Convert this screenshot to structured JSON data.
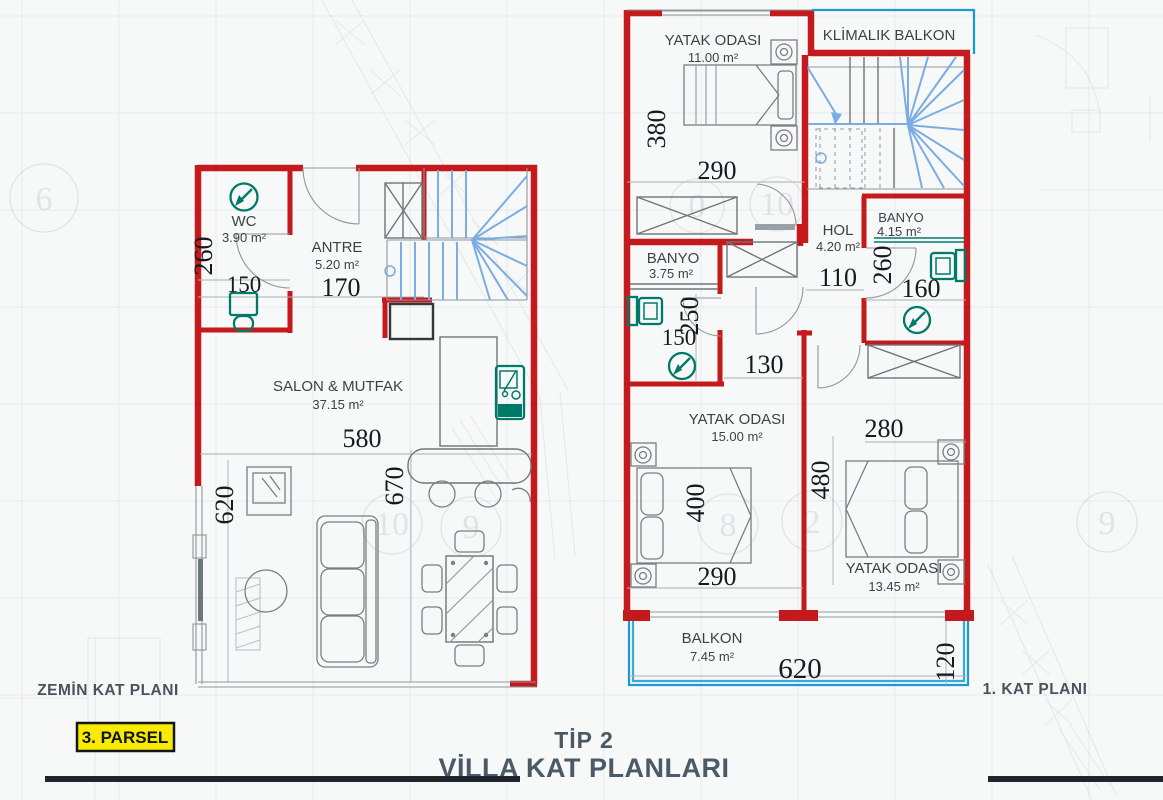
{
  "ground_floor": {
    "plan_label": "ZEMİN KAT PLANI",
    "rooms": {
      "wc": {
        "name": "WC",
        "area": "3.90 m²"
      },
      "antre": {
        "name": "ANTRE",
        "area": "5.20 m²"
      },
      "salon": {
        "name": "SALON & MUTFAK",
        "area": "37.15 m²"
      }
    },
    "dims": {
      "left_height": "260",
      "wc_width": "150",
      "antre_width": "170",
      "salon_width": "580",
      "salon_height_right": "670",
      "salon_height_left": "620"
    }
  },
  "first_floor": {
    "plan_label": "1. KAT PLANI",
    "rooms": {
      "bedroom1": {
        "name": "YATAK ODASI",
        "area": "11.00 m²"
      },
      "klimalik_balkon": {
        "name": "KLİMALIK BALKON"
      },
      "hol": {
        "name": "HOL",
        "area": "4.20 m²"
      },
      "banyo_right": {
        "name": "BANYO",
        "area": "4.15 m²"
      },
      "banyo_left": {
        "name": "BANYO",
        "area": "3.75 m²"
      },
      "bedroom2": {
        "name": "YATAK ODASI",
        "area": "15.00 m²"
      },
      "bedroom3": {
        "name": "YATAK ODASI",
        "area": "13.45 m²"
      },
      "balkon": {
        "name": "BALKON",
        "area": "7.45 m²"
      }
    },
    "dims": {
      "bedroom1_height": "380",
      "bedroom1_width": "290",
      "hol_width": "110",
      "banyo_right_height": "260",
      "banyo_right_width": "160",
      "banyo_left_height": "250",
      "banyo_left_width": "150",
      "corridor_width": "130",
      "bedroom3_width": "280",
      "bedroom2_height": "400",
      "bedroom2_width": "290",
      "bedroom3_height": "480",
      "balkon_width": "620",
      "balkon_height": "120"
    }
  },
  "footer": {
    "type_label": "TİP 2",
    "title": "VİLLA KAT PLANLARI",
    "parsel_label": "3. PARSEL"
  },
  "ghosts": {
    "n6": "6",
    "n10_left": "10",
    "n9_left": "9",
    "n0": "0",
    "n10_right": "10",
    "n8": "8",
    "n2": "2",
    "n9_right": "9"
  },
  "colors": {
    "wall_red": "#c4191d",
    "balcony_cyan": "#189bd5",
    "fixture_teal": "#007a68",
    "stair_blue": "#7aade3",
    "parsel_yellow": "#f8eb00",
    "title_gray_blue": "#4a5a66",
    "dimension_text": "#17191c"
  }
}
